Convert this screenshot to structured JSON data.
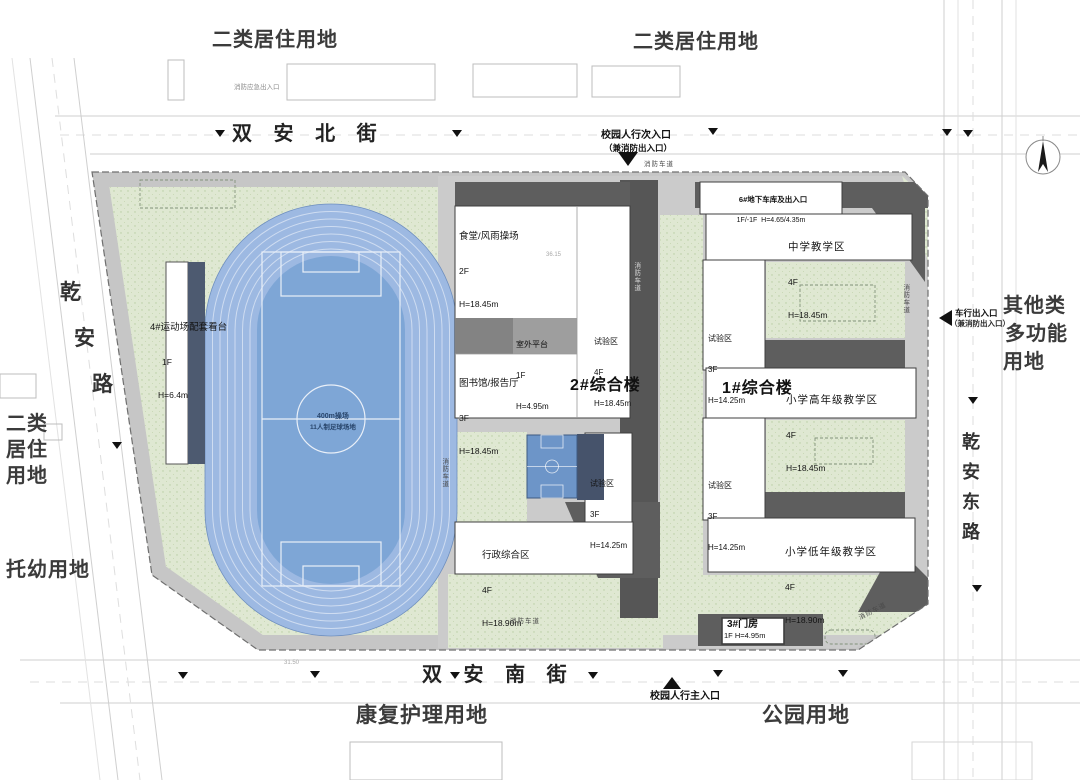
{
  "title": "学校校园总平面图",
  "colors": {
    "site_green": "#dfe8d2",
    "green_dot": "#b7cda1",
    "paving_gray": "#cbcbcb",
    "shadow_gray": "#5e5e5e",
    "track_blue": "#9db9e2",
    "field_blue": "#7ea6d6",
    "court_blue": "#6d95c8",
    "stand_dark": "#4d5a70",
    "building_white": "#ffffff",
    "context_line": "#cfcfcf",
    "text_dark": "#2e2e2e"
  },
  "land_use": {
    "top_left": "二类居住用地",
    "top_right": "二类居住用地",
    "right": {
      "line1": "其他类",
      "line2": "多功能",
      "line3": "用地"
    },
    "left": {
      "line1": "二类",
      "line2": "居住",
      "line3": "用地"
    },
    "left_bottom": "托幼用地",
    "bottom": "康复护理用地",
    "bottom_right": "公园用地"
  },
  "streets": {
    "north": "双 安 北 街",
    "south": "双 安 南 街",
    "west": {
      "c1": "乾",
      "c2": "安",
      "c3": "路"
    },
    "east": {
      "c1": "乾",
      "c2": "安",
      "c3": "东",
      "c4": "路"
    }
  },
  "entrances": {
    "north_secondary": {
      "line1": "校园人行次入口",
      "line2": "（兼消防出入口）"
    },
    "south_main": "校园人行主入口",
    "east_vehicle": {
      "line1": "车行出入口",
      "line2": "（兼消防出入口）"
    },
    "nw_emergency": "消防应急出入口"
  },
  "buildings": {
    "canteen": {
      "name": "食堂/风雨操场",
      "floors": "2F",
      "height": "H=18.45m"
    },
    "terrace": {
      "name": "室外平台",
      "floors": "1F",
      "height": "H=4.95m"
    },
    "library": {
      "name": "图书馆/报告厅",
      "floors": "3F",
      "height": "H=18.45m"
    },
    "lab_center_4f": {
      "name": "试验区",
      "floors": "4F",
      "height": "H=18.45m"
    },
    "complex2_label": "2#综合楼",
    "lab_center_3f": {
      "name": "试验区",
      "floors": "3F",
      "height": "H=14.25m"
    },
    "admin": {
      "name": "行政综合区",
      "floors": "4F",
      "height": "H=18.90m"
    },
    "garage6": {
      "name": "6#地下车库及出入口",
      "spec": "1F/-1F  H=4.65/4.35m"
    },
    "middle_school": {
      "name": "中学教学区",
      "floors": "4F",
      "height": "H=18.45m"
    },
    "lab_right_upper": {
      "name": "试验区",
      "floors": "3F",
      "height": "H=14.25m"
    },
    "complex1_label": "1#综合楼",
    "primary_upper": {
      "name": "小学高年级教学区",
      "floors": "4F",
      "height": "H=18.45m"
    },
    "lab_right_lower": {
      "name": "试验区",
      "floors": "3F",
      "height": "H=14.25m"
    },
    "primary_lower": {
      "name": "小学低年级教学区",
      "floors": "4F",
      "height": "H=18.90m"
    },
    "gatehouse3": {
      "name": "3#门房",
      "spec": "1F H=4.95m"
    },
    "stand4": {
      "name": "4#运动场配套看台",
      "floors": "1F",
      "height": "H=6.4m"
    }
  },
  "field": {
    "line1": "400m操场",
    "line2": "11人制足球场地"
  },
  "road_labels": {
    "fire_lane": "消防车道"
  },
  "annotations": {
    "n1": "36.15",
    "n2": "31.50"
  }
}
